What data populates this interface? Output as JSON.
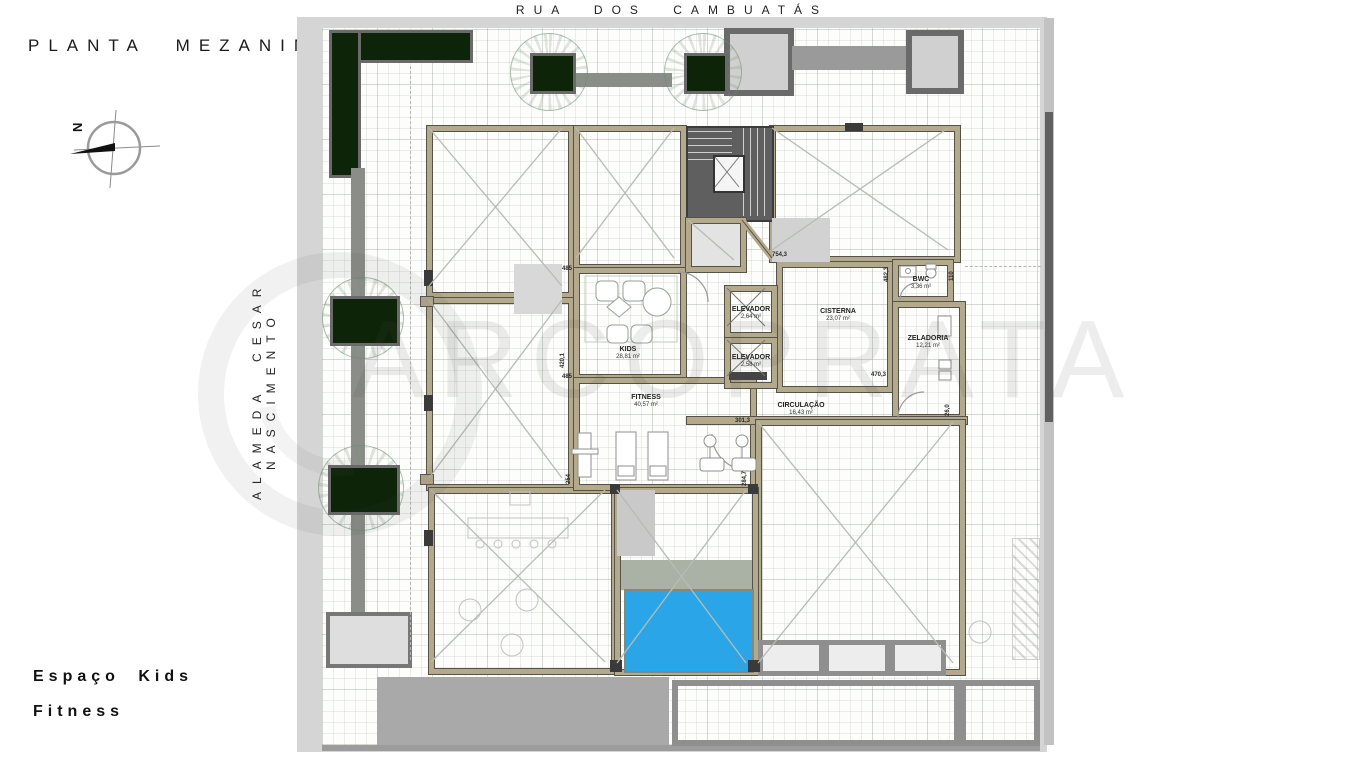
{
  "title": "PLANTA MEZANINO",
  "streets": {
    "top": "RUA DOS CAMBUATÁS",
    "left": "ALAMEDA CESAR NASCIMENTO"
  },
  "legend": {
    "line1": "Espaço Kids",
    "line2": "Fitness"
  },
  "compass": {
    "north": "N"
  },
  "watermark": {
    "text": "ARCOPRATA"
  },
  "colors": {
    "pool_water": "#2aa6e8",
    "pool_deck": "#a9b2a4",
    "planter_green": "#0e2409",
    "wall_tan": "#b3a98c",
    "stairs_gray": "#5f5f5f",
    "sidewalk_gray": "#d5d5d5",
    "terrace_gray": "#a9a9a9",
    "path_gray": "#8a8d88"
  },
  "room_labels": [
    {
      "name": "KIDS",
      "area": "28,81 m²",
      "x": 628,
      "y": 346
    },
    {
      "name": "FITNESS",
      "area": "40,57 m²",
      "x": 646,
      "y": 394
    },
    {
      "name": "ELEVADOR",
      "area": "2,64 m²",
      "x": 751,
      "y": 306
    },
    {
      "name": "ELEVADOR",
      "area": "2,58 m²",
      "x": 751,
      "y": 354
    },
    {
      "name": "CISTERNA",
      "area": "23,07 m²",
      "x": 838,
      "y": 308
    },
    {
      "name": "CIRCULAÇÃO",
      "area": "16,43 m²",
      "x": 801,
      "y": 402
    },
    {
      "name": "BWC",
      "area": "3,36 m²",
      "x": 921,
      "y": 276
    },
    {
      "name": "ZELADORIA",
      "area": "12,21 m²",
      "x": 928,
      "y": 335
    }
  ],
  "dimension_labels": [
    {
      "text": "485",
      "x": 562,
      "y": 266,
      "rot": 0
    },
    {
      "text": "420,1",
      "x": 560,
      "y": 368,
      "rot": 90
    },
    {
      "text": "485",
      "x": 562,
      "y": 374,
      "rot": 0
    },
    {
      "text": "254",
      "x": 566,
      "y": 484,
      "rot": 90
    },
    {
      "text": "284,7",
      "x": 742,
      "y": 486,
      "rot": 90
    },
    {
      "text": "754,3",
      "x": 772,
      "y": 252,
      "rot": 0
    },
    {
      "text": "482,3",
      "x": 884,
      "y": 282,
      "rot": 90
    },
    {
      "text": "470,3",
      "x": 871,
      "y": 372,
      "rot": 0
    },
    {
      "text": "301,3",
      "x": 735,
      "y": 418,
      "rot": 0
    },
    {
      "text": "26,0",
      "x": 945,
      "y": 416,
      "rot": 90
    },
    {
      "text": "110",
      "x": 949,
      "y": 281,
      "rot": 90
    }
  ]
}
